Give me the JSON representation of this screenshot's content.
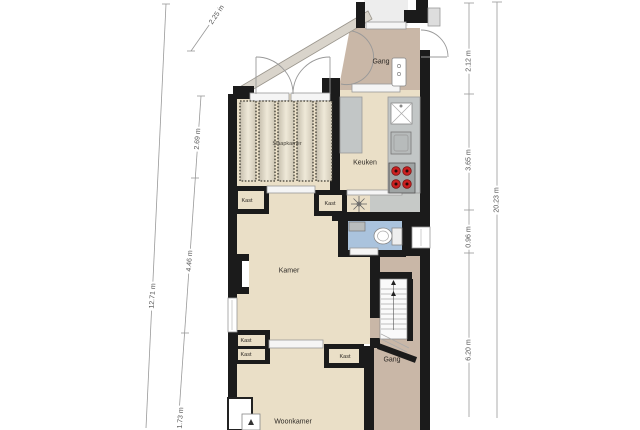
{
  "title": "floor-plan",
  "rooms": {
    "entry_hall": "Gang",
    "kitchen": "Keuken",
    "striped_room": "Slaapkamer",
    "closet": "Kast",
    "room": "Kamer",
    "hall": "Gang",
    "living_room": "Woonkamer"
  },
  "dims": {
    "left_segments": [
      "2.25 m",
      "2.69 m",
      "4.46 m",
      "1.73 m"
    ],
    "left_total": "12.71 m",
    "right_segments": [
      "2.12 m",
      "3.65 m",
      "0.96 m",
      "6.20 m"
    ],
    "right_total": "20.23 m"
  },
  "colors": {
    "floor_cream": "#eadfc7",
    "floor_tan": "#c9b7a7",
    "floor_blue": "#aac3dd",
    "counter_gray": "#c2c6c6",
    "wall_black": "#1b1b1b",
    "burner_red": "#cc2020"
  }
}
